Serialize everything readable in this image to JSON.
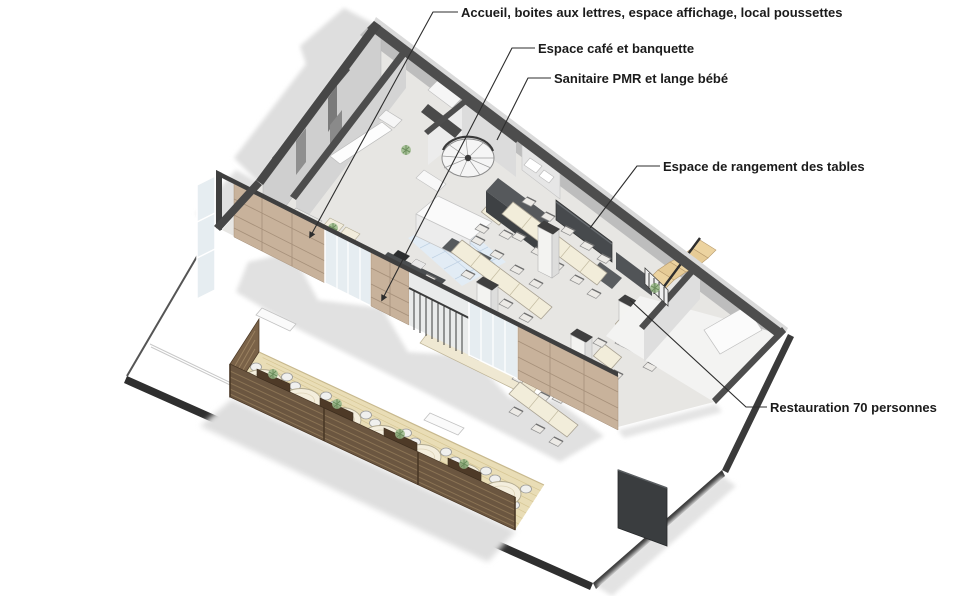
{
  "figure": {
    "type": "axonometric-cutaway-floor-plan",
    "language": "fr",
    "subject": "Rez-de-chaussée restaurant / café avec terrasse"
  },
  "annotations": [
    {
      "id": "accueil",
      "text": "Accueil, boites aux lettres, espace affichage, local poussettes"
    },
    {
      "id": "cafe",
      "text": "Espace café et banquette"
    },
    {
      "id": "sanitaire",
      "text": "Sanitaire PMR et lange bébé"
    },
    {
      "id": "rangement",
      "text": "Espace de rangement des tables"
    },
    {
      "id": "restauration",
      "text": "Restauration 70 personnes"
    }
  ],
  "scene": {
    "elements": [
      "ground-slab",
      "building-shell",
      "reception-area",
      "cafe-bar-counter",
      "sanitary-room",
      "spiral-staircase",
      "table-storage-cabinets",
      "wooden-staircase",
      "dining-tables",
      "columns",
      "terrace-deck",
      "terrace-fence-planters",
      "terrace-round-tables"
    ],
    "capacity": "70"
  },
  "colors": {
    "background": "#ffffff",
    "wall_cut": "#4a4a4a",
    "wall_face": "#d2d2d2",
    "wood_facade": "#c8b29b",
    "deck": "#e9ddb6",
    "fence": "#6b5640",
    "planter": "#4e3a27",
    "table_top": "#f2edda",
    "floor": "#e7e6e3",
    "tile": "#e2ecf5",
    "stair_wood": "#ecd3a0",
    "plant": "#9ab989",
    "shadow": "#dcdcdc",
    "dark_wall": "#3a3d3f",
    "leader": "#2d2d2d"
  }
}
